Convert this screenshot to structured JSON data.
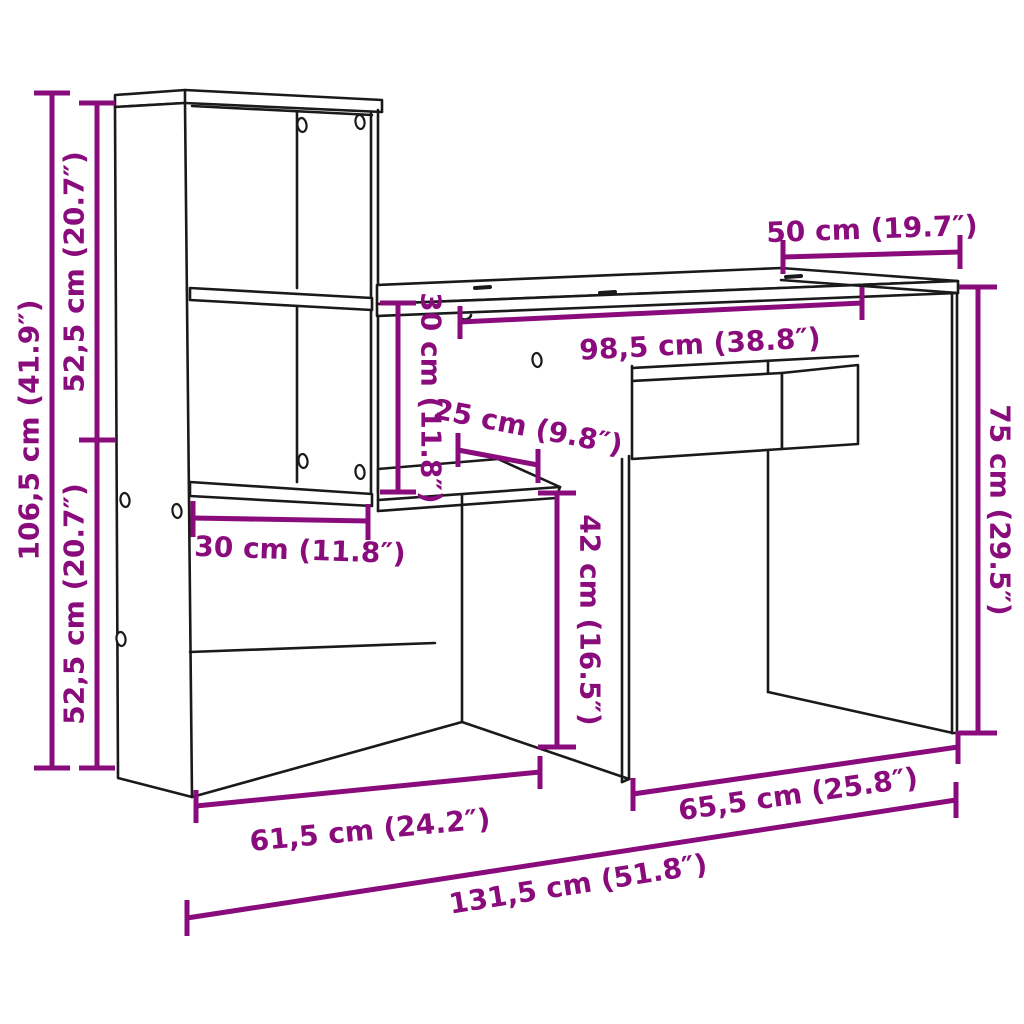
{
  "diagram": {
    "kind": "furniture-dimension-diagram",
    "subject": "desk-with-shelving-unit",
    "colors": {
      "dimension_accent": "#8A0C7C",
      "drawing_line": "#1A1A1A",
      "background": "#FFFFFF"
    }
  },
  "dimensions": {
    "total_height": "106,5 cm (41.9″)",
    "upper_section_height": "52,5 cm (20.7″)",
    "lower_section_height": "52,5 cm (20.7″)",
    "desktop_depth": "50 cm (19.7″)",
    "inner_width": "98,5 cm (38.8″)",
    "desktop_to_shelf": "30 cm (11.8″)",
    "small_shelf_depth": "25 cm (9.8″)",
    "shelf_depth": "30 cm (11.8″)",
    "under_shelf_clearance": "42 cm (16.5″)",
    "desk_height": "75 cm (29.5″)",
    "left_section_width": "61,5 cm (24.2″)",
    "right_section_width": "65,5 cm (25.8″)",
    "total_width": "131,5 cm (51.8″)"
  }
}
